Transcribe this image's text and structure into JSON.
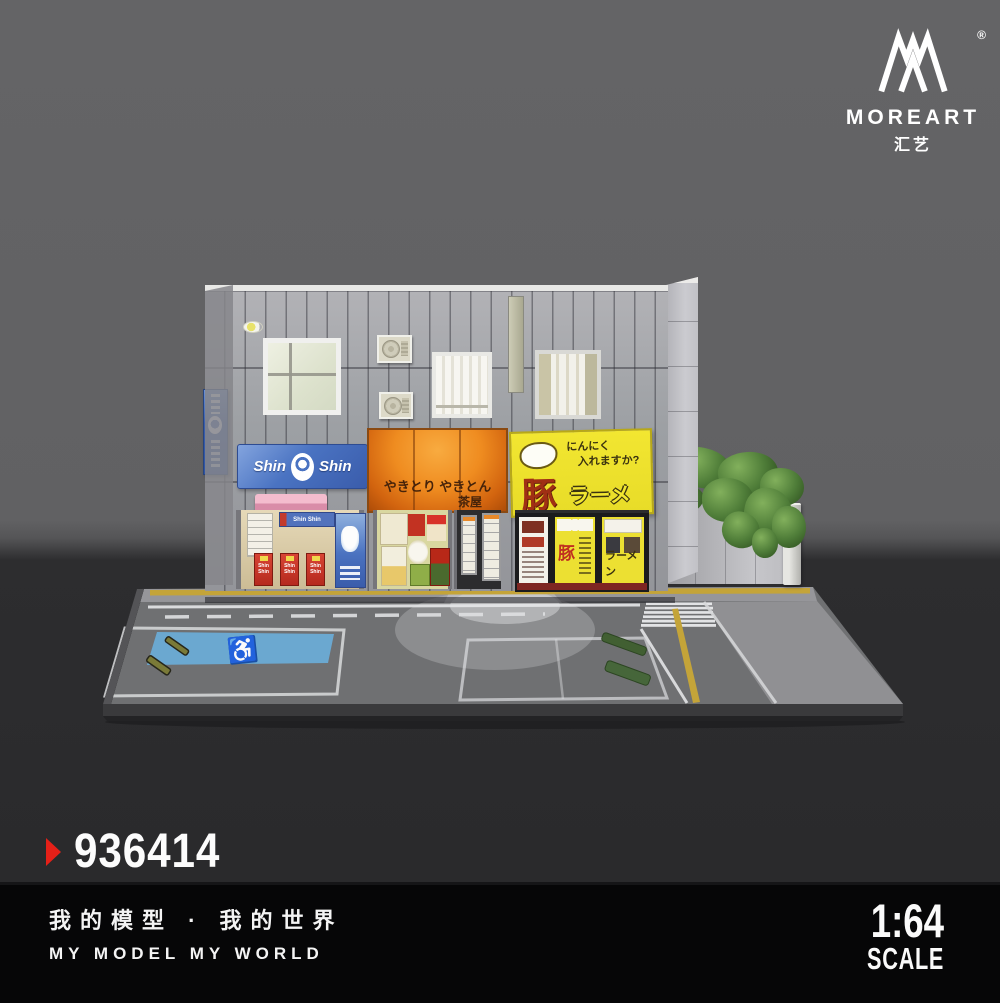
{
  "brand": {
    "registered": "®",
    "name": "MOREART",
    "name_cn": "汇艺"
  },
  "product": {
    "code": "936414",
    "marker_color": "#e52018"
  },
  "footer": {
    "slogan_cn": "我的模型 · 我的世界",
    "slogan_en": "MY MODEL MY WORLD",
    "scale_value": "1:64",
    "scale_label": "SCALE"
  },
  "diorama": {
    "signs": {
      "shinshin_left": "Shin",
      "shinshin_right": "Shin",
      "orange_line1": "やきとり やきとん",
      "orange_line2": "茶屋",
      "yellow_line1": "にんにく",
      "yellow_line2": "入れますか?",
      "yellow_main": "豚",
      "yellow_sub": "ラーメン",
      "banner_text": "Shin Shin",
      "window_main": "豚",
      "window_sub": "ラーメン",
      "handicap_symbol": "♿"
    },
    "colors": {
      "backdrop_top": "#616163",
      "backdrop_bottom": "#2a2a2c",
      "sign_blue": "#4a73c2",
      "sign_orange": "#ef8c20",
      "sign_yellow": "#efe22e",
      "awning_pink": "#eba9bf",
      "hedge_green": "#4e7c38",
      "handicap_blue": "#6ba8d0",
      "road_line_yellow": "#c4a439"
    }
  }
}
